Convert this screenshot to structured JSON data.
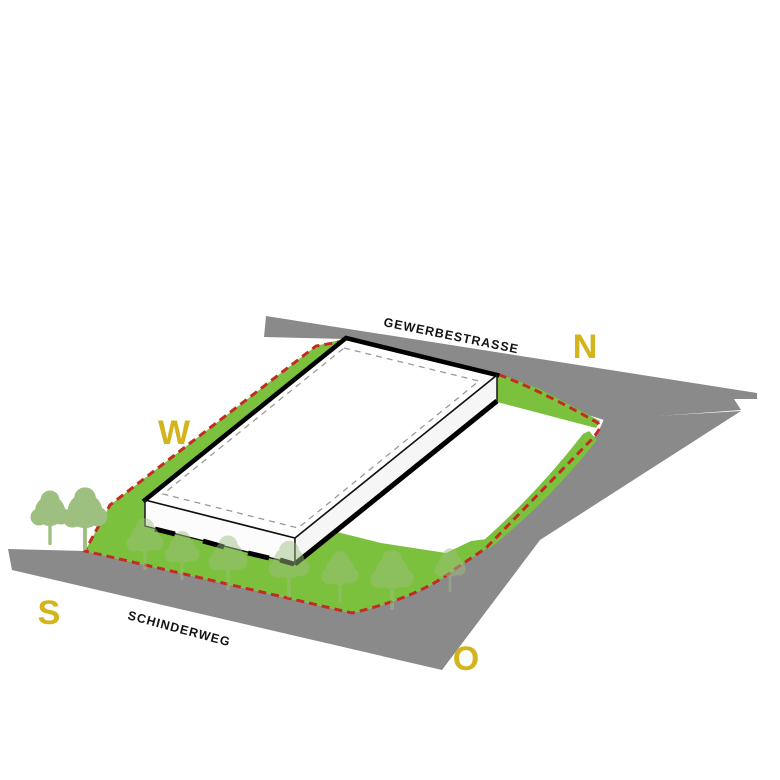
{
  "streets": {
    "north_road_label": "GEWERBESTRASSE",
    "south_road_label": "SCHINDERWEG"
  },
  "compass": {
    "north": "N",
    "west": "W",
    "south": "S",
    "east": "O"
  },
  "colors": {
    "road": "#8a8a8a",
    "lawn": "#7cc13e",
    "boundary": "#c32c22",
    "compass": "#d4b41c",
    "tree": "#9dbf80",
    "building_face": "#ffffff",
    "outline": "#000000",
    "background": "#ffffff"
  }
}
